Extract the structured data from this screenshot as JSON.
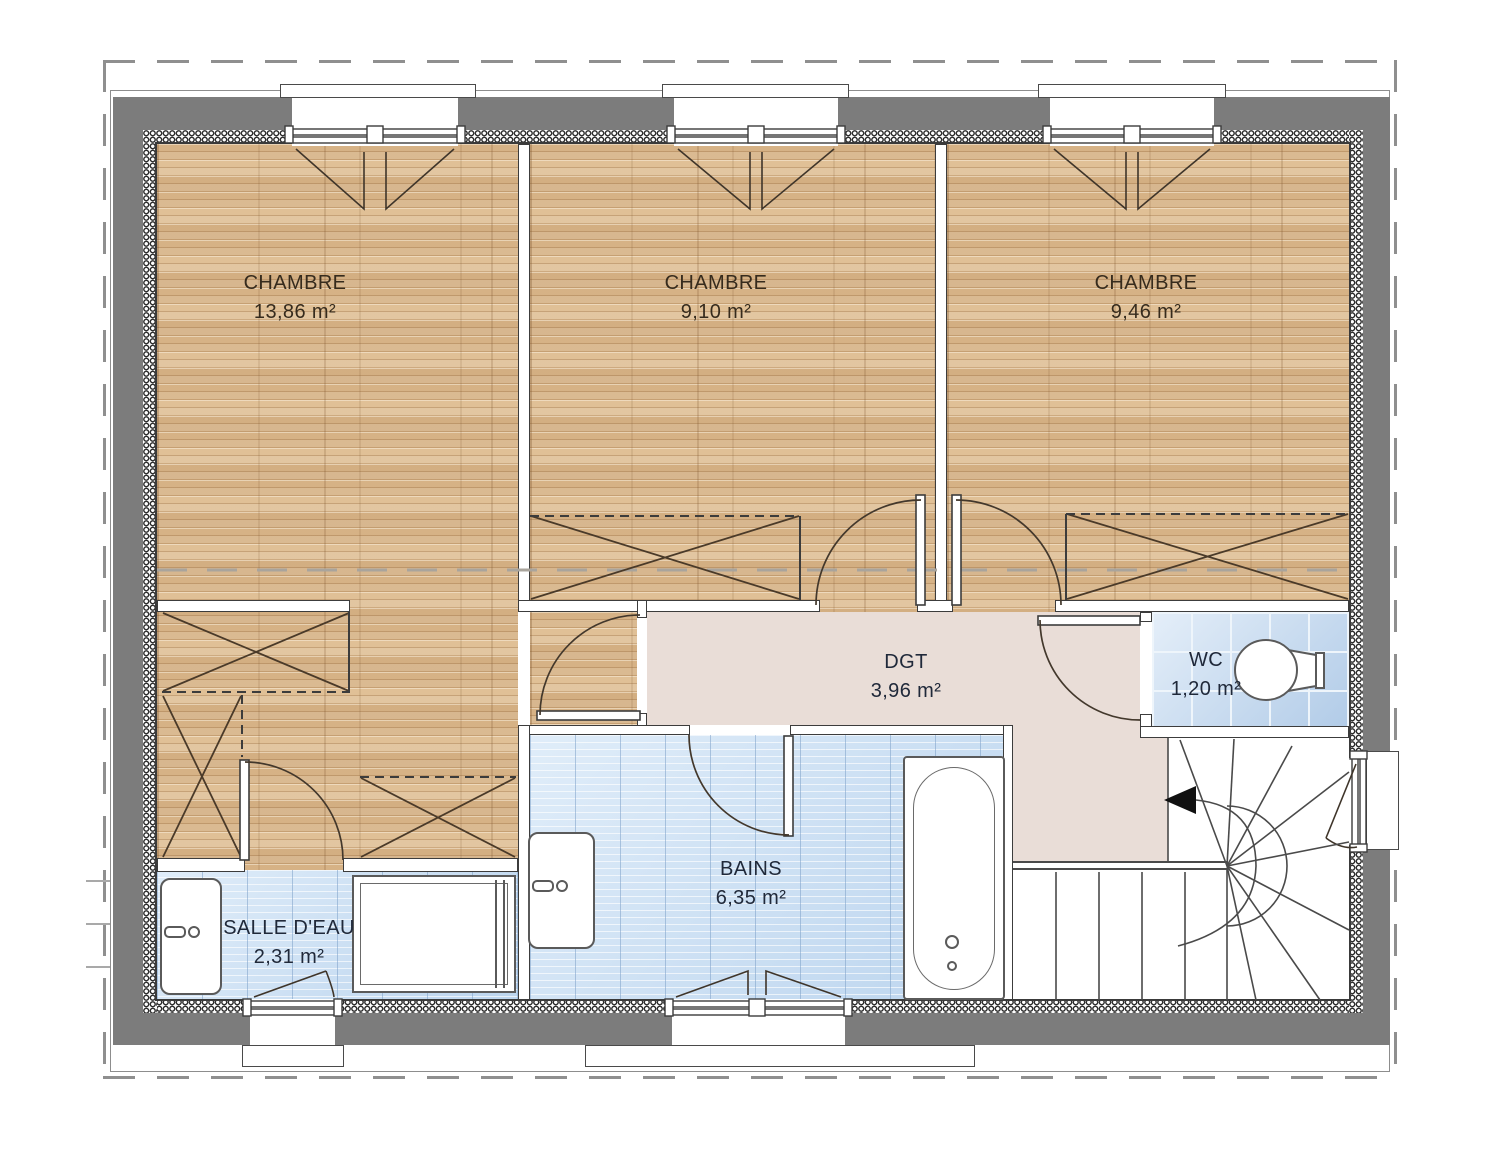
{
  "plan": {
    "rooms": [
      {
        "id": "chambre-1",
        "name": "CHAMBRE",
        "area": "13,86 m²"
      },
      {
        "id": "chambre-2",
        "name": "CHAMBRE",
        "area": "9,10 m²"
      },
      {
        "id": "chambre-3",
        "name": "CHAMBRE",
        "area": "9,46 m²"
      },
      {
        "id": "dgt",
        "name": "DGT",
        "area": "3,96 m²"
      },
      {
        "id": "wc",
        "name": "WC",
        "area": "1,20 m²"
      },
      {
        "id": "bains",
        "name": "BAINS",
        "area": "6,35 m²"
      },
      {
        "id": "salle-deau",
        "name": "SALLE D'EAU",
        "area": "2,31 m²"
      }
    ],
    "colors": {
      "exterior_wall": "#7c7c7c",
      "wood_floor": "#d9b78c",
      "wet_room_tile": "#cfe3f6",
      "wc_tile": "#cadef3",
      "hallway_floor": "#e9ddd7",
      "linework": "#3f352a"
    }
  }
}
